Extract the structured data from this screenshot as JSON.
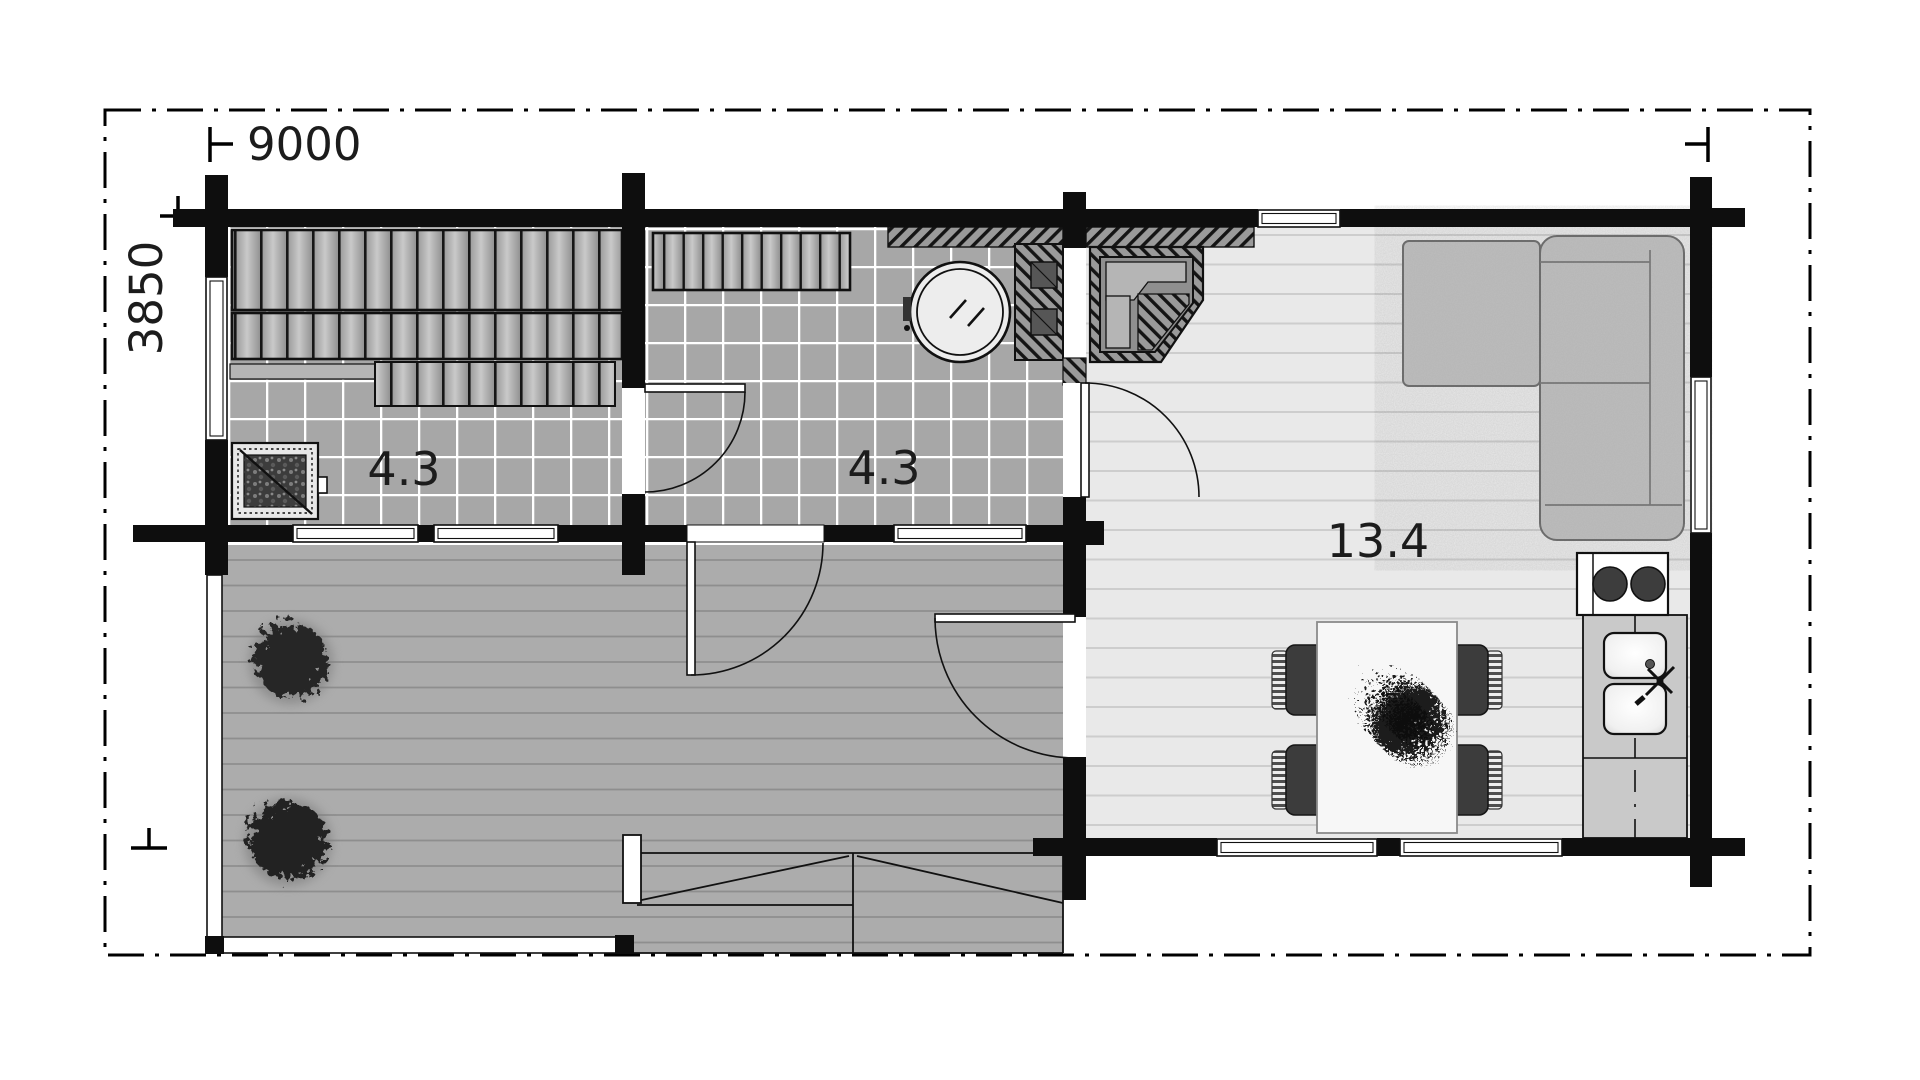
{
  "plan": {
    "dimensions": {
      "width": "9000",
      "height": "3850"
    },
    "rooms": [
      {
        "name": "sauna",
        "area": "4.3"
      },
      {
        "name": "shower-room",
        "area": "4.3"
      },
      {
        "name": "living-room",
        "area": "13.4"
      }
    ],
    "colors": {
      "bg": "#ffffff",
      "wall": "#0e0e0e",
      "tile": "#a7a7a7",
      "deck": "#acacac",
      "floor": "#e9e9e9",
      "sofa": "#bdbdbd",
      "counter": "#c9c9c9",
      "label": "#1c1c1c"
    }
  }
}
